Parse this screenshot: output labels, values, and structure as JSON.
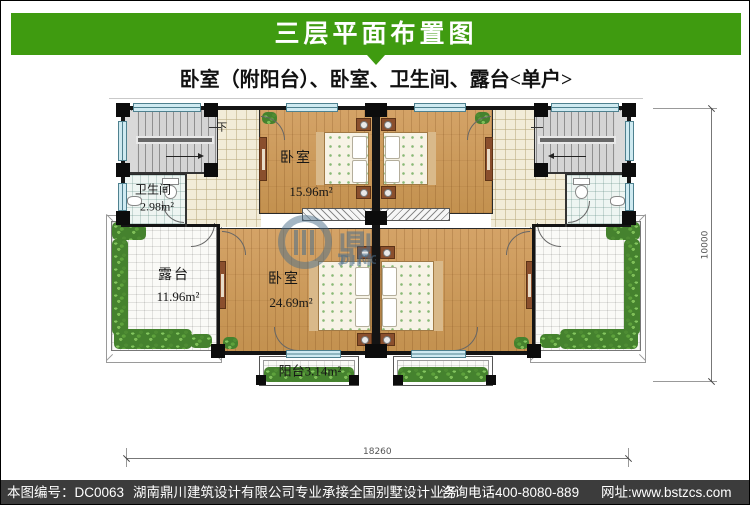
{
  "header": {
    "title": "三层平面布置图"
  },
  "subtitle": "卧室（附阳台）、卧室、卫生间、露台<单户>",
  "plan": {
    "bedroom_small": {
      "name": "卧室",
      "area": "15.96m²"
    },
    "bedroom_large": {
      "name": "卧室",
      "area": "24.69m²"
    },
    "bathroom": {
      "name": "卫生间",
      "area": "2.98m²"
    },
    "terrace": {
      "name": "露台",
      "area": "11.96m²"
    },
    "balcony": {
      "label": "阳台3.14m²"
    },
    "stairs": {
      "down_label": "下"
    },
    "dimensions": {
      "width": "18260",
      "height": "10000"
    },
    "watermark": {
      "cn": "鼎川建筑",
      "en": "DINGCHUAN JIANZHU"
    }
  },
  "footer": {
    "drawing_no": "本图编号：DC0063",
    "company": "湖南鼎川建筑设计有限公司专业承接全国别墅设计业务",
    "phone": "咨询电话400-8080-889",
    "website": "网址:www.bstzcs.com"
  },
  "colors": {
    "accent_green": "#3F9B10",
    "footer_bg": "#3C3C3C",
    "wood": "#CD9C60",
    "window": "#CFEAF1",
    "watermark": "#4A6E8A"
  }
}
